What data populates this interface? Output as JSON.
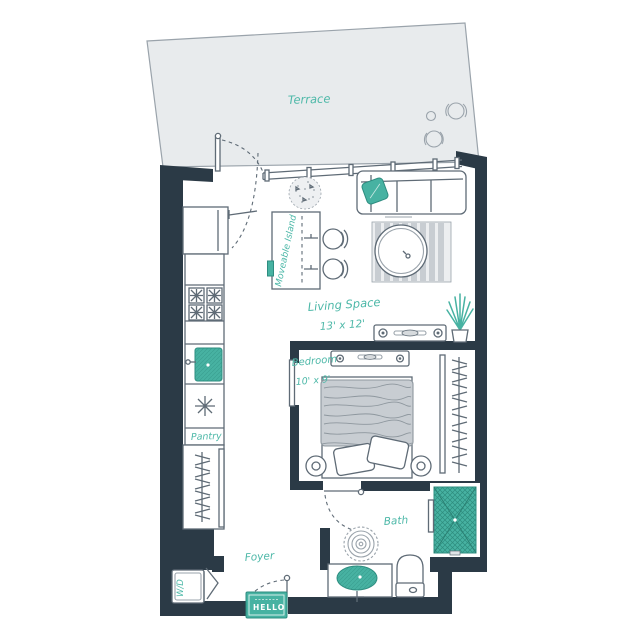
{
  "meta": {
    "title": "Studio apartment floor plan"
  },
  "colors": {
    "wall": "#2b3a46",
    "teal": "#47b2a2",
    "teal_dark": "#2e8d80",
    "teal_text": "#4db8a8",
    "terrace_fill": "#e8ebed",
    "furniture_gray": "#c8cdd2",
    "line": "#5f6b76",
    "line_light": "#9aa3ab"
  },
  "rooms": {
    "terrace": {
      "label": "Terrace"
    },
    "living": {
      "label": "Living Space",
      "dims": "13' x 12'"
    },
    "bedroom": {
      "label": "Bedroom",
      "dims": "10' x 9'"
    },
    "bath": {
      "label": "Bath"
    },
    "foyer": {
      "label": "Foyer"
    },
    "pantry": {
      "label": "Pantry"
    },
    "island": {
      "label": "Moveable Island"
    },
    "laundry": {
      "label": "W/D"
    },
    "doormat": {
      "label": "HELLO"
    }
  }
}
